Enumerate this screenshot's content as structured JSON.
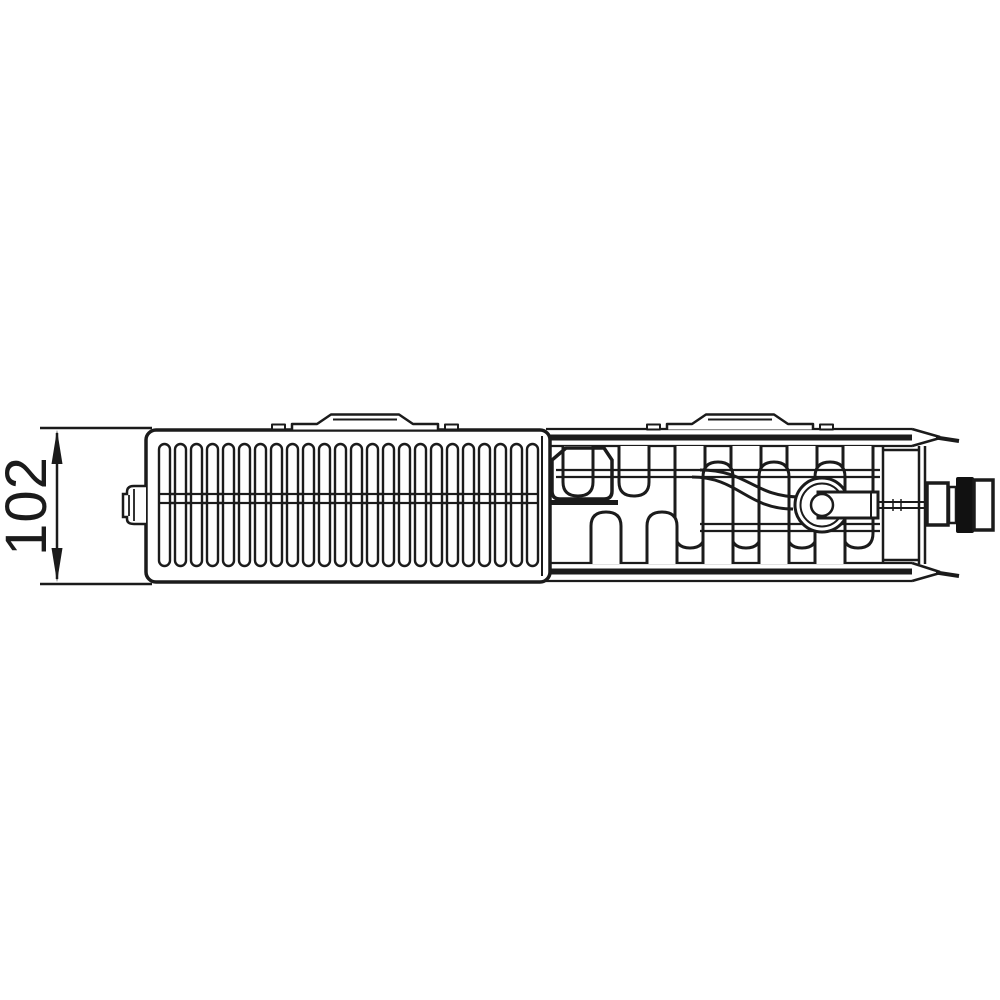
{
  "drawing": {
    "dimension_label": "102",
    "line_color": "#1b1b1b",
    "background_color": "#ffffff"
  }
}
